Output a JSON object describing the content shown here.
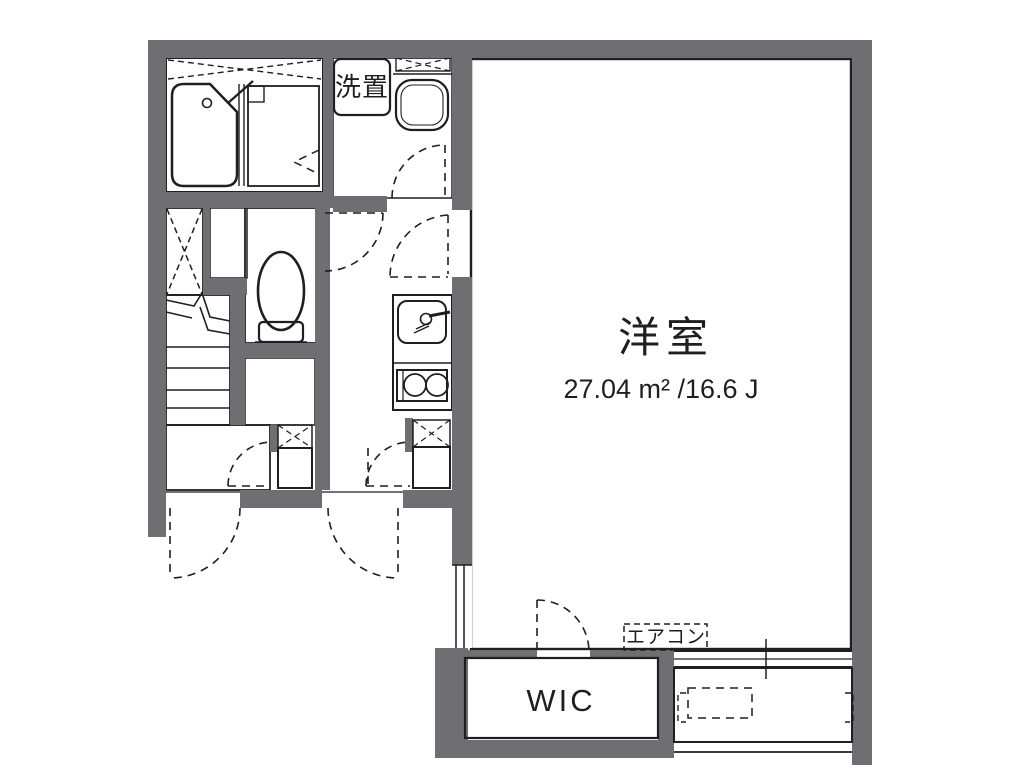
{
  "plan": {
    "type": "floor-plan",
    "main_room": {
      "label": "洋室",
      "area_label": "27.04 m² /16.6 J"
    },
    "washer_space": {
      "label": "洗置"
    },
    "walk_in_closet": {
      "label": "WIC"
    },
    "air_conditioner": {
      "label": "エアコン"
    },
    "fixtures": [
      "bathtub",
      "shower-room",
      "washbasin",
      "washing-machine-space",
      "toilet",
      "staircase",
      "kitchen-sink",
      "two-burner-stove",
      "storage-closet",
      "storage-closet",
      "walk-in-closet",
      "air-conditioner",
      "balcony",
      "sliding-window",
      "entry-doors"
    ]
  },
  "colors": {
    "bg": "#ffffff",
    "wall": "#6f6e72",
    "water": "#dfe9f7",
    "waterlight": "#eaf2fb",
    "stairs": "#b4b3b6",
    "closet": "#fcf0d8",
    "line": "#1f1f1f"
  }
}
